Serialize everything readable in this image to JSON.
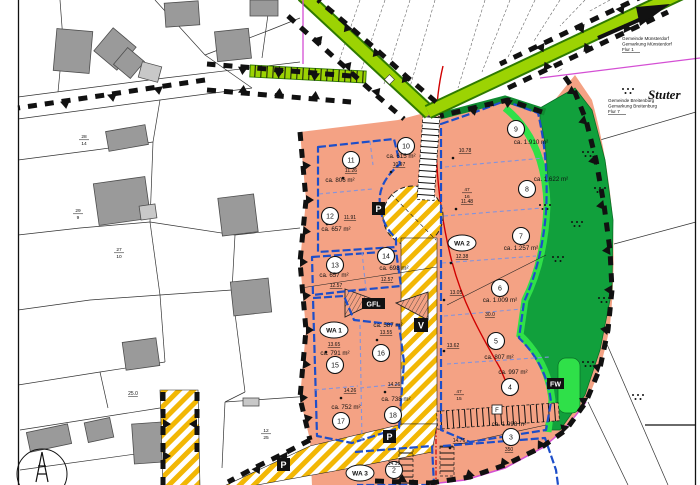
{
  "map": {
    "kind": "development-plan",
    "zone_labels": {
      "wa1": "WA 1",
      "wa2": "WA 2",
      "wa3": "WA 3"
    },
    "signs": {
      "p1": "P",
      "p2": "P",
      "p3": "P",
      "v": "V",
      "fw": "FW",
      "gfl": "GFL",
      "f": "F"
    },
    "place_label": "Stuter",
    "municipality_note_1": {
      "l1": "Gemeinde Münsterdorf",
      "l2": "Gemarkung Münsterdorf",
      "l3": "Flur 1"
    },
    "municipality_note_2": {
      "l1": "Gemeinde Breitenburg",
      "l2": "Gemarkung Breitenburg",
      "l3": "Flur 7"
    },
    "lots": [
      {
        "n": "2",
        "a": ""
      },
      {
        "n": "3",
        "a": "ca. 1.098 m²"
      },
      {
        "n": "4",
        "a": "ca. 997 m²"
      },
      {
        "n": "5",
        "a": "ca. 807 m²"
      },
      {
        "n": "6",
        "a": "ca. 1.009 m²"
      },
      {
        "n": "7",
        "a": "ca. 1.257 m²"
      },
      {
        "n": "8",
        "a": "ca. 1.622 m²"
      },
      {
        "n": "9",
        "a": "ca. 1.910 m²"
      },
      {
        "n": "10",
        "a": "ca. 615 m²"
      },
      {
        "n": "11",
        "a": "ca. 806 m²"
      },
      {
        "n": "12",
        "a": "ca. 657 m²"
      },
      {
        "n": "13",
        "a": "ca. 657 m²"
      },
      {
        "n": "14",
        "a": "ca. 698 m²"
      },
      {
        "n": "15",
        "a": "ca. 791 m²"
      },
      {
        "n": "16",
        "a": "ca. 587 m²"
      },
      {
        "n": "17",
        "a": "ca. 752 m²"
      },
      {
        "n": "18",
        "a": "ca. 738 m²"
      }
    ],
    "dims": {
      "m1078": "10.78",
      "m1097": "10.97",
      "m1126": "11.26",
      "m1148": "11.48",
      "m1191": "11.91",
      "m1238": "12.38",
      "m1257a": "12.57",
      "m1257b": "12.57",
      "m1305": "13.05",
      "m1355": "13.55",
      "m1362": "13.62",
      "m1365": "13.65",
      "m1426a": "14.26",
      "m1426b": "14.26",
      "m1439": "14.39",
      "m1476": "14.76",
      "m250": "25.0",
      "m350": "350",
      "m300": "30.0"
    },
    "parcels": {
      "a_top": "47",
      "a_bot": "16",
      "b_top": "47",
      "b_bot": "15",
      "c_top": "28",
      "c_bot": "14",
      "d_top": "29",
      "d_bot": "9",
      "e_top": "27",
      "e_bot": "10",
      "f_top": "12",
      "f_bot": "25"
    },
    "colors": {
      "residential_zone": "#F4A284",
      "planned_road_stripe": "#F2B705",
      "green_road": "#9CD303",
      "green_path": "#2FE049",
      "planting_area": "#11A03C",
      "building_limit_blue": "#1D4EC9",
      "boundary_black": "#111111",
      "red_line": "#D00000",
      "magenta_line": "#D44FD4"
    }
  }
}
